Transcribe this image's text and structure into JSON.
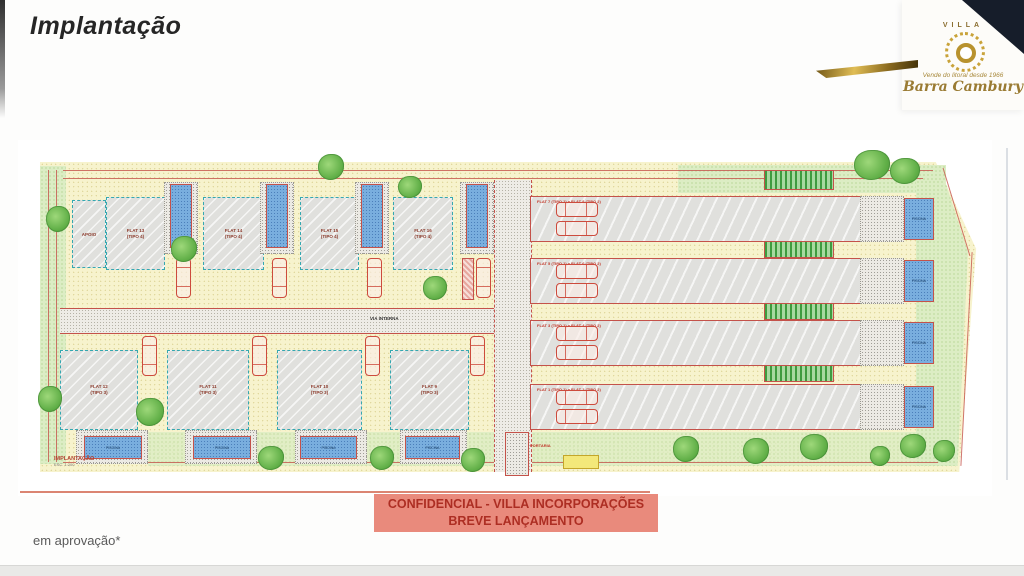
{
  "page": {
    "title": "Implantação",
    "footnote": "em aprovação*"
  },
  "logo": {
    "brand": "VILLA",
    "monogram": "O",
    "tagline": "Vende do litoral desde 1966",
    "name": "Barra Cambury"
  },
  "banner": {
    "line1": "CONFIDENCIAL - VILLA INCORPORAÇÕES",
    "line2": "BREVE LANÇAMENTO"
  },
  "plan": {
    "caption": {
      "title": "IMPLANTAÇÃO",
      "scale": "ESC. 1:200"
    },
    "road_label": "VIA INTERNA",
    "gate_label": "PORTARIA",
    "apoio_label": "APOIO",
    "pool_label": "PISCINA",
    "top_flats": [
      {
        "name": "FLAT 13",
        "tipo": "(TIPO 4)"
      },
      {
        "name": "FLAT 14",
        "tipo": "(TIPO 4)"
      },
      {
        "name": "FLAT 15",
        "tipo": "(TIPO 4)"
      },
      {
        "name": "FLAT 16",
        "tipo": "(TIPO 4)"
      }
    ],
    "bottom_flats": [
      {
        "name": "FLAT 12",
        "tipo": "(TIPO 3)"
      },
      {
        "name": "FLAT 11",
        "tipo": "(TIPO 3)"
      },
      {
        "name": "FLAT 10",
        "tipo": "(TIPO 3)"
      },
      {
        "name": "FLAT 9",
        "tipo": "(TIPO 3)"
      }
    ],
    "row_flats": [
      {
        "label": "FLAT 7 (TIPO 1) e FLAT 8 (TIPO 2)"
      },
      {
        "label": "FLAT 5 (TIPO 1) e FLAT 6 (TIPO 2)"
      },
      {
        "label": "FLAT 3 (TIPO 1) e FLAT 4 (TIPO 2)"
      },
      {
        "label": "FLAT 1 (TIPO 1) e FLAT 2 (TIPO 2)"
      }
    ]
  },
  "colors": {
    "banner_bg": "#e98a7c",
    "banner_text": "#ad2e23",
    "gold": "#c9a33a",
    "navy": "#161d2a",
    "pool_blue": "#79aede",
    "site_yellow": "#f7f3cd",
    "grass_green": "#9cc474",
    "dimension_red": "#c4524a"
  }
}
